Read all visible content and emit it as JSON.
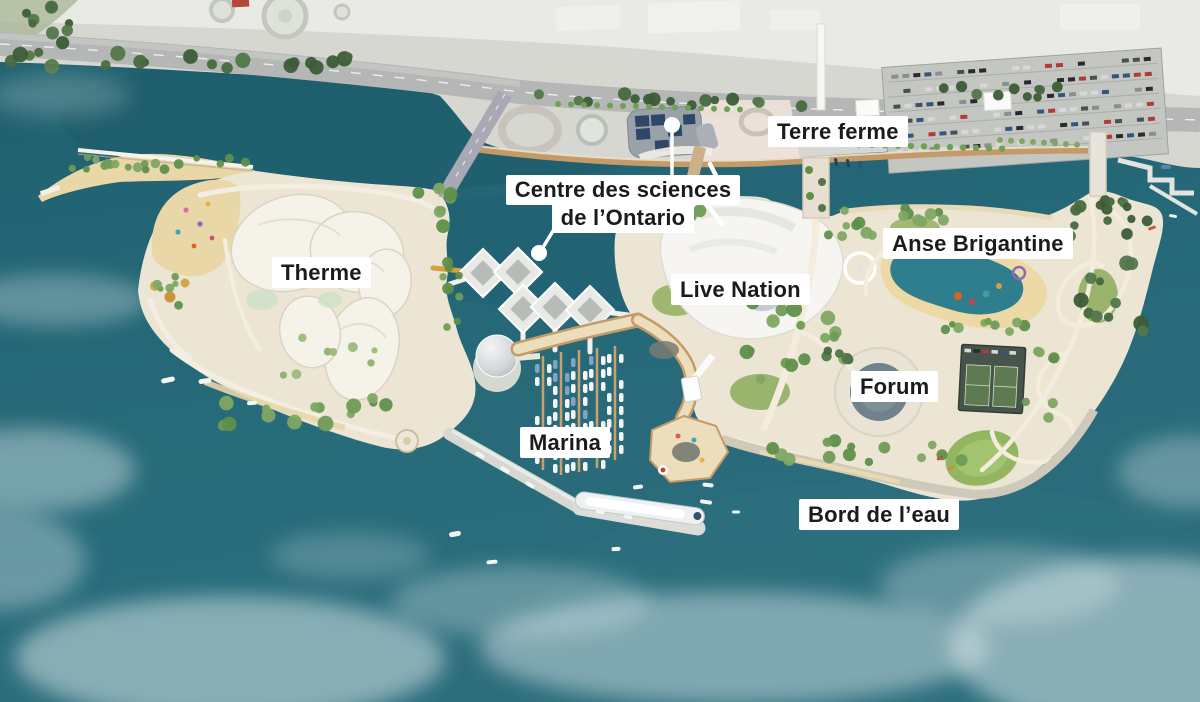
{
  "labels": {
    "terre_ferme": {
      "text": "Terre ferme"
    },
    "centre_sciences": {
      "line1": "Centre des sciences",
      "line2": "de l’Ontario"
    },
    "anse_brigantine": {
      "text": "Anse Brigantine"
    },
    "therme": {
      "text": "Therme"
    },
    "live_nation": {
      "text": "Live Nation"
    },
    "forum": {
      "text": "Forum"
    },
    "marina": {
      "text": "Marina"
    },
    "bord_de_leau": {
      "text": "Bord de l’eau"
    }
  },
  "palette": {
    "water": "#236674",
    "water_deep": "#1d5b69",
    "cove_water": "#2f7e8e",
    "sand": "#e9d7a8",
    "island_ground": "#ece5d4",
    "mainland": "#d6d7d1",
    "mainland_pale": "#e9eae6",
    "parking": "#c4c6c2",
    "road": "#b4b7b5",
    "wood_deck": "#c49a66",
    "deck_pale": "#ecddbd",
    "roof_white": "#f6f5f1",
    "pier_grey": "#d7d8d2",
    "tree_dark": "#3f5d3b",
    "tree_mid": "#5f8f4a",
    "label_bg": "#ffffff",
    "label_text": "#1b1b1b",
    "leader": "#ffffff"
  }
}
